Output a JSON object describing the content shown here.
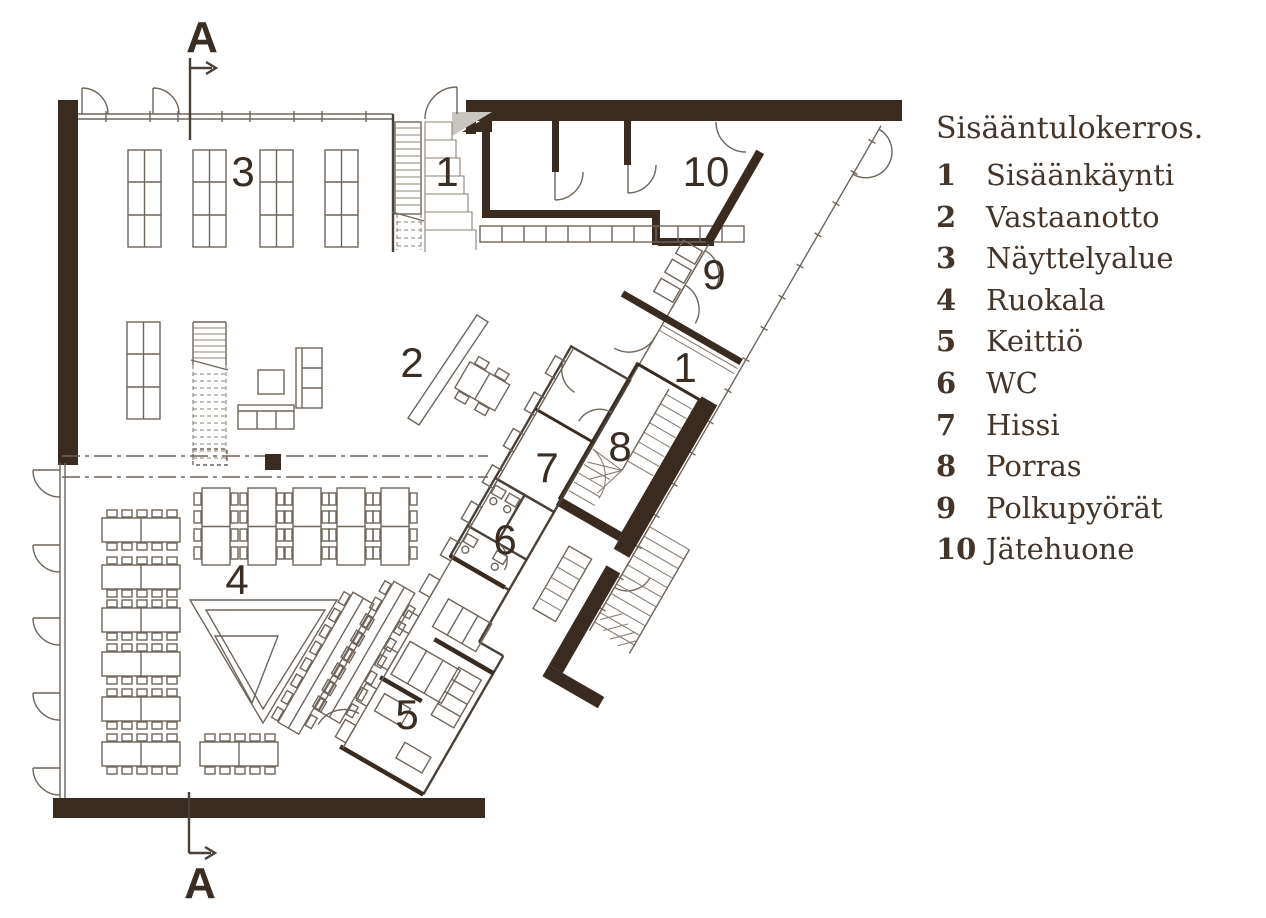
{
  "legend": {
    "title": "Sisääntulokerros.",
    "items": [
      {
        "num": "1",
        "label": "Sisäänkäynti"
      },
      {
        "num": "2",
        "label": "Vastaanotto"
      },
      {
        "num": "3",
        "label": "Näyttelyalue"
      },
      {
        "num": "4",
        "label": "Ruokala"
      },
      {
        "num": "5",
        "label": "Keittiö"
      },
      {
        "num": "6",
        "label": "WC"
      },
      {
        "num": "7",
        "label": "Hissi"
      },
      {
        "num": "8",
        "label": "Porras"
      },
      {
        "num": "9",
        "label": "Polkupyörät"
      },
      {
        "num": "10",
        "label": "Jätehuone"
      }
    ]
  },
  "section": {
    "label_top": "A",
    "label_bottom": "A"
  },
  "plan": {
    "room_numbers": {
      "exhibition": "3",
      "entrance_top": "1",
      "waste": "10",
      "bikes": "9",
      "reception": "2",
      "entrance_corridor": "1",
      "elevator": "7",
      "stairs": "8",
      "wc": "6",
      "dining": "4",
      "kitchen": "5"
    },
    "colors": {
      "wall": "#3a2b20",
      "thin_line": "#6f655b",
      "light_fill": "#c9c6c2",
      "text": "#3a2d23",
      "legend_text": "#44352a",
      "background": "#ffffff"
    }
  }
}
